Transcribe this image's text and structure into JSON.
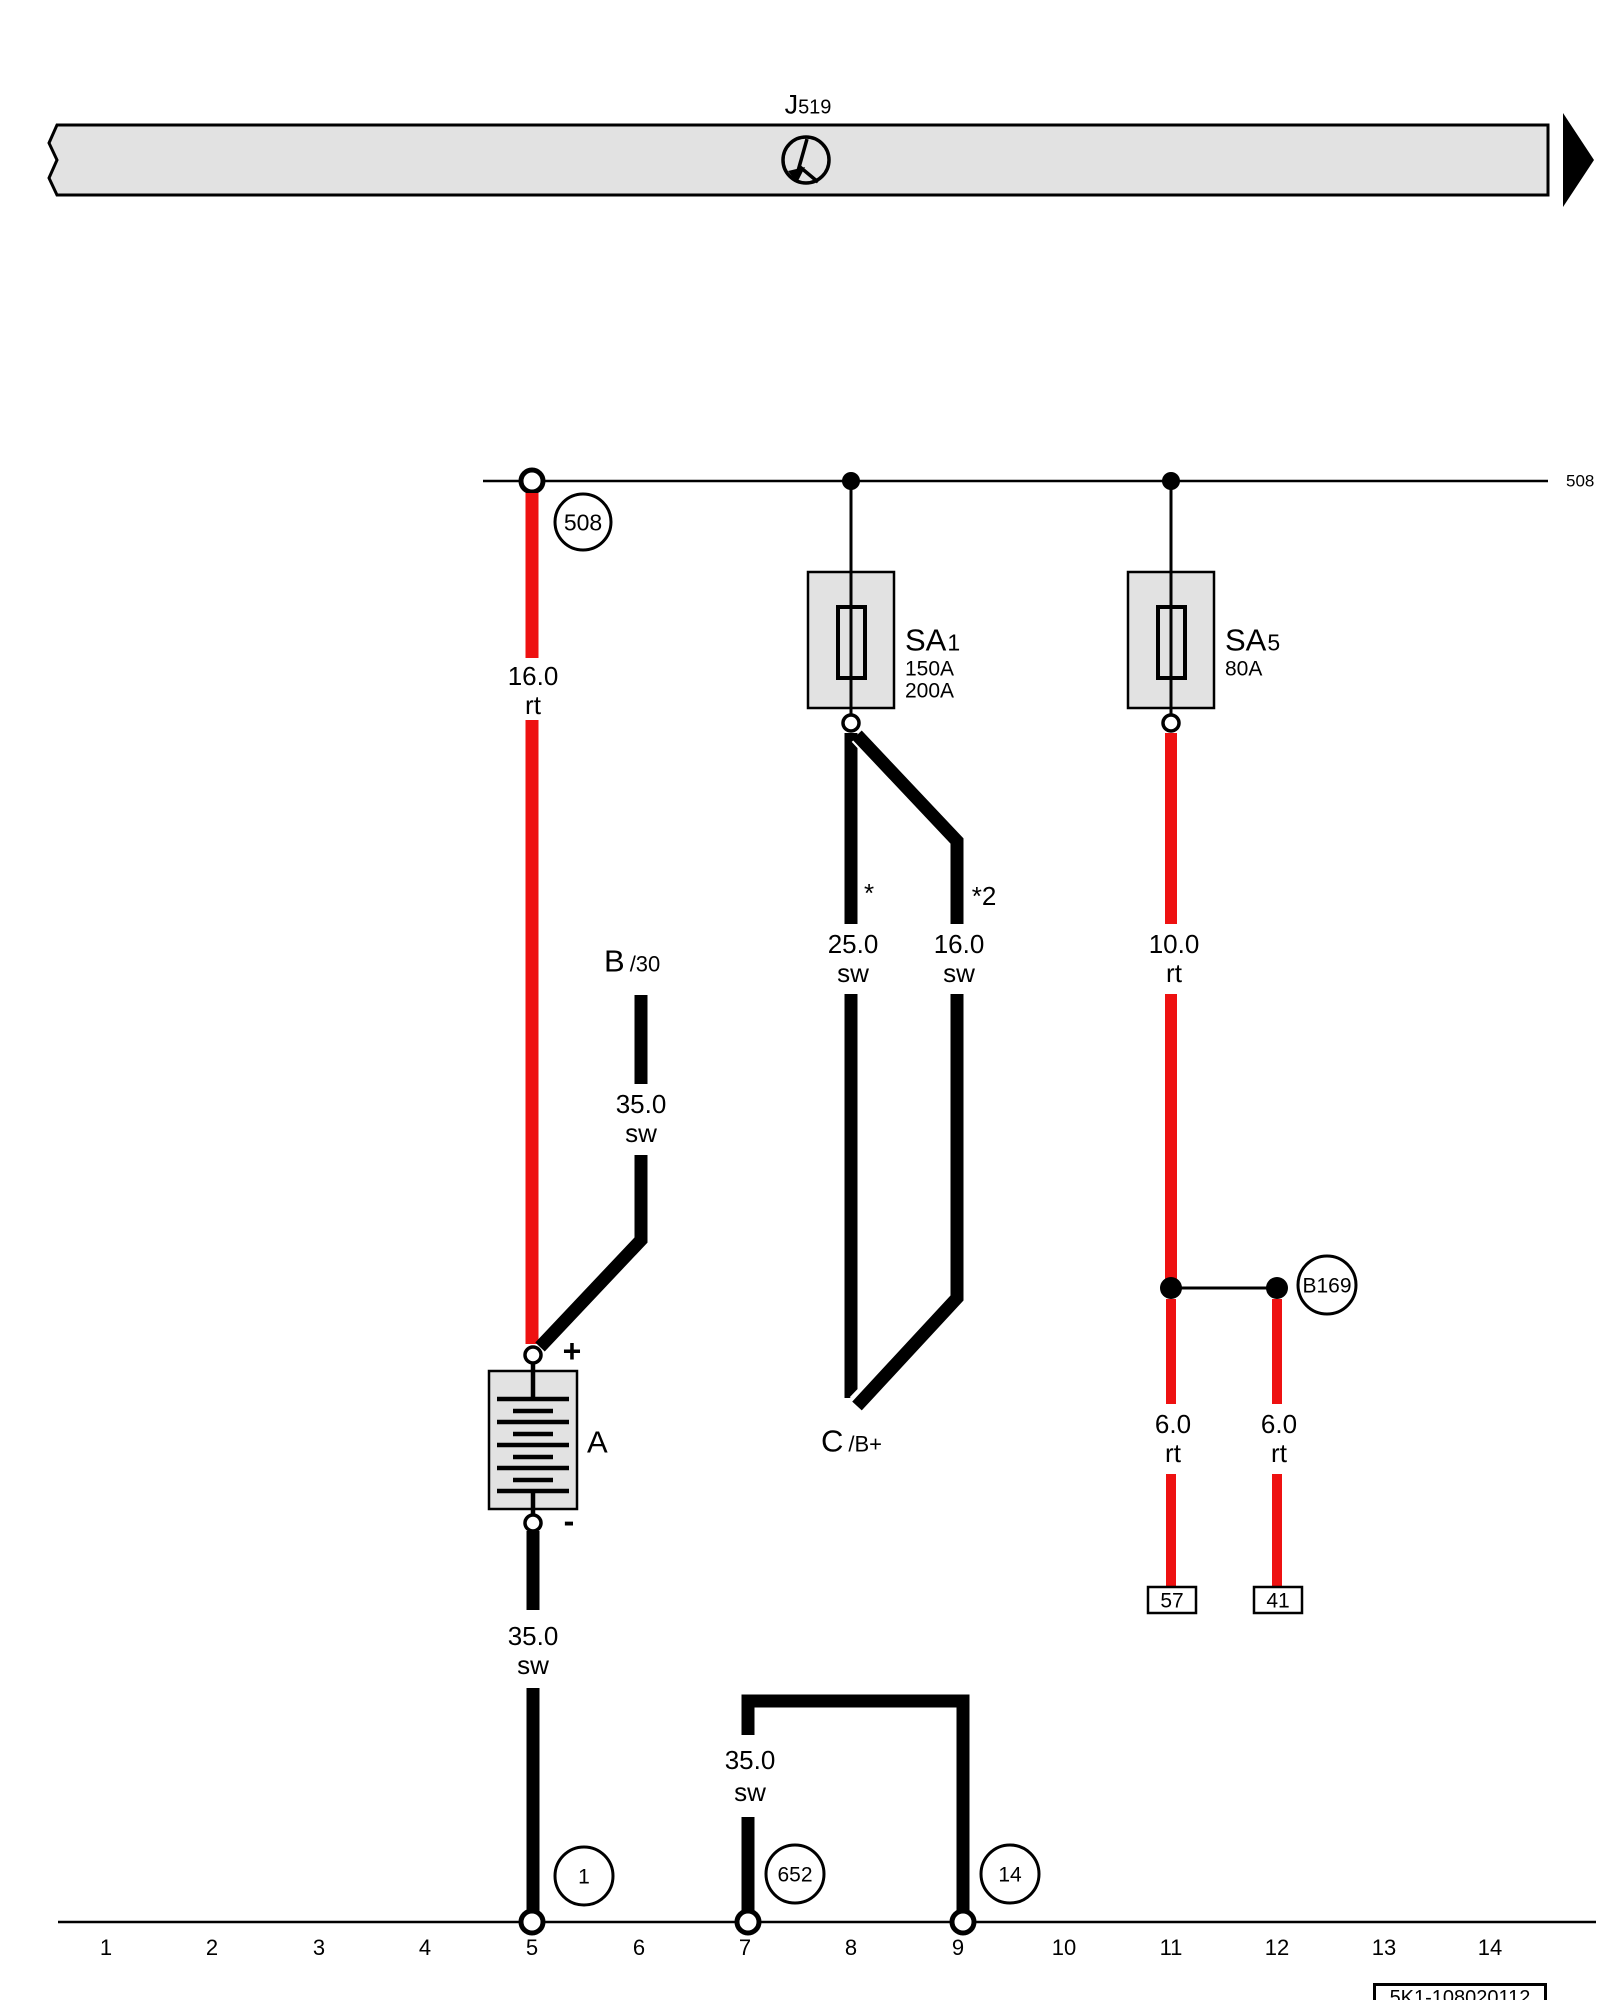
{
  "control_module": {
    "name": "J",
    "name_sub": "519"
  },
  "rails": {
    "top_right_label": "508",
    "bottom_numbers": [
      "1",
      "2",
      "3",
      "4",
      "5",
      "6",
      "7",
      "8",
      "9",
      "10",
      "11",
      "12",
      "13",
      "14"
    ]
  },
  "connection_circles": {
    "top": "508",
    "b169": "B169",
    "bottom_left": "1",
    "bottom_mid": "652",
    "bottom_right": "14"
  },
  "fuses": {
    "sa1": {
      "name": "SA",
      "sub": "1",
      "ratings": [
        "150A",
        "200A"
      ]
    },
    "sa5": {
      "name": "SA",
      "sub": "5",
      "ratings": [
        "80A"
      ]
    }
  },
  "battery": {
    "label": "A",
    "plus": "+",
    "minus": "-"
  },
  "terminals": {
    "b": {
      "name": "B",
      "sub": "/30"
    },
    "c": {
      "name": "C",
      "sub": "/B+"
    },
    "t57": "57",
    "t41": "41"
  },
  "wires": {
    "batt_pos": {
      "gauge": "16.0",
      "color": "rt"
    },
    "b30": {
      "gauge": "35.0",
      "color": "sw"
    },
    "sa1_left": {
      "gauge": "25.0",
      "color": "sw",
      "note": "*"
    },
    "sa1_right": {
      "gauge": "16.0",
      "color": "sw",
      "note": "*2"
    },
    "sa5_down": {
      "gauge": "10.0",
      "color": "rt"
    },
    "b169_left": {
      "gauge": "6.0",
      "color": "rt"
    },
    "b169_right": {
      "gauge": "6.0",
      "color": "rt"
    },
    "batt_neg": {
      "gauge": "35.0",
      "color": "sw"
    },
    "bridge": {
      "gauge": "35.0",
      "color": "sw"
    }
  },
  "footer": {
    "code": "5K1-108020112"
  },
  "colors": {
    "wire_red": "#ee1111",
    "wire_black": "#000000",
    "box_fill": "#e2e2e2"
  }
}
